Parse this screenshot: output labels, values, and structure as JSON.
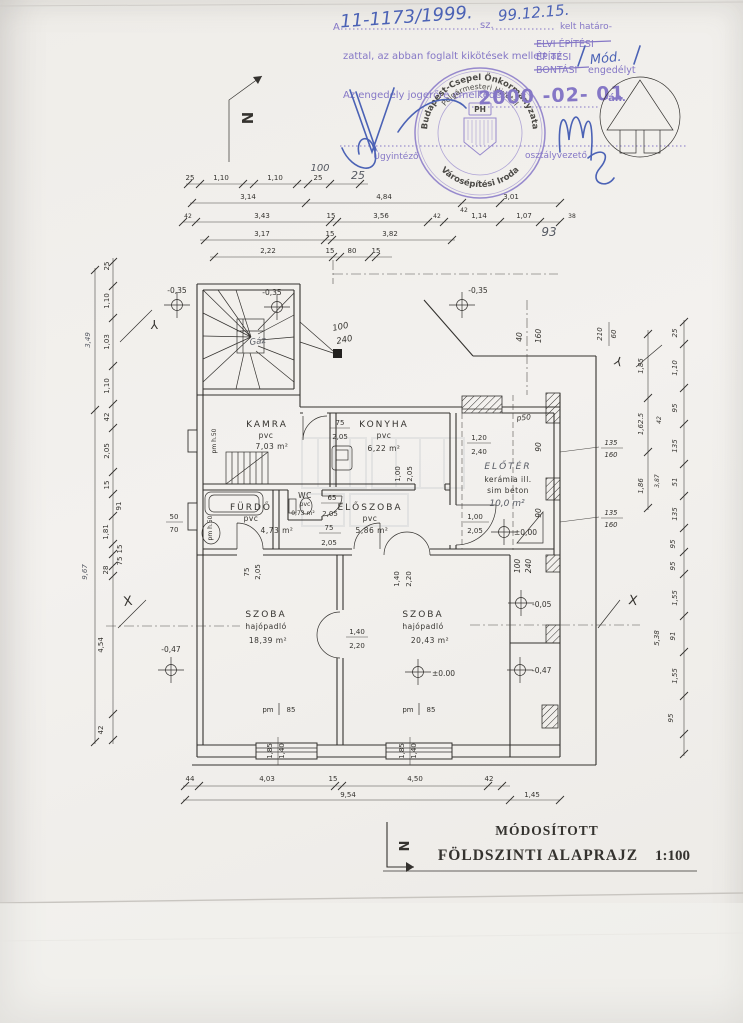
{
  "permit": {
    "a": "A",
    "case": "11-1173/1999.",
    "sz": "sz.",
    "date": "99.12.15.",
    "kelt": "kelt határo-",
    "l2": "zattal, az abban foglalt kikötések mellett az",
    "o1": "ELVI ÉPÍTÉSI",
    "o2": "ÉPÍTÉSI",
    "mod": "Mód.",
    "o3": "BONTÁSI",
    "eng": "engedélyt",
    "l3": "Az engedély jogerőre emelkedett",
    "stamp_date": "2000 -02- 01",
    "an": "-án.",
    "sig1": "Ügyintéző",
    "sig2": "osztályvezető"
  },
  "seal": {
    "r1": "Budapest-Csepel Önkormányzata",
    "r2": "Polgármesteri Hivatal",
    "ph": "PH",
    "r3": "Városépítési Iroda"
  },
  "title": {
    "t1": "MÓDOSÍTOTT",
    "t2": "FÖLDSZINTI ALAPRAJZ",
    "scale": "1:100"
  },
  "rooms": {
    "kamra": {
      "n": "KAMRA",
      "f": "pvc",
      "a": "7,03 m²"
    },
    "konyha": {
      "n": "KONYHA",
      "f": "pvc",
      "a": "6,22 m²"
    },
    "wc": {
      "n": "WC",
      "f": "pvc",
      "a": "0,73 m²"
    },
    "furdo": {
      "n": "FÜRDŐ",
      "f": "pvc",
      "a": "4,73 m²"
    },
    "eloszoba": {
      "n": "ELŐSZOBA",
      "f": "pvc",
      "a": "5,86 m²"
    },
    "eloter": {
      "n": "ELŐTÉR",
      "f1": "kerámia ill.",
      "f2": "sim beton",
      "a": "10,0 m²"
    },
    "szoba1": {
      "n": "SZOBA",
      "f": "hajópadló",
      "a": "18,39 m²"
    },
    "szoba2": {
      "n": "SZOBA",
      "f": "hajópadló",
      "a": "20,43 m²"
    },
    "gaz": "Gáz",
    "pm85": {
      "pm": "pm",
      "v": "85"
    },
    "pmh50": "pm h.50"
  },
  "levels": {
    "a": "-0,35",
    "b": "-0,35",
    "c": "-0,35",
    "d": "±0,00",
    "e": "±0.00",
    "f": "-0,05",
    "g": "-0,47",
    "h": "-0,47"
  },
  "doors": {
    "kamra": [
      "75",
      "2,05"
    ],
    "konyha_elo": [
      "1,00",
      "2,05"
    ],
    "wc": [
      "65",
      "2,05"
    ],
    "elo1": [
      "75",
      "2,05"
    ],
    "furdo_door": [
      "75",
      "2,05"
    ],
    "eloter_door": [
      "1,00",
      "2,05"
    ],
    "eloter_win": [
      "1,20",
      "2,40"
    ],
    "dbl": [
      "1,40",
      "2,20"
    ],
    "win2": [
      "1,40",
      "2,20"
    ],
    "furdo_win": [
      "50",
      "70"
    ],
    "win_a": [
      "1,85",
      "1,40"
    ],
    "win_b": [
      "1,85",
      "1,40"
    ],
    "wing_a": [
      "100",
      "240"
    ],
    "hw40": [
      "40",
      "160"
    ],
    "hw210": [
      "210",
      "60"
    ],
    "hw135a": [
      "135",
      "160"
    ],
    "hw135b": [
      "135",
      "160"
    ],
    "hw100240": [
      "100",
      "240"
    ]
  },
  "dims": {
    "t0": [
      "25",
      "1,10",
      "1,10",
      "25"
    ],
    "t0h": [
      "100",
      "25"
    ],
    "t1": [
      "3,14",
      "4,84",
      "42",
      "3,01"
    ],
    "t2": [
      "42",
      "3,43",
      "15",
      "3,56",
      "42",
      "1,14",
      "1,07",
      "38"
    ],
    "t2h": "93",
    "t3": [
      "3,17",
      "15",
      "3,82"
    ],
    "t4": [
      "2,22",
      "15",
      "80",
      "15"
    ],
    "b1": [
      "44",
      "4,03",
      "15",
      "4,50",
      "42"
    ],
    "b2": [
      "9,54",
      "1,45"
    ],
    "L": [
      "25",
      "1,10",
      "1,03",
      "1,10",
      "42",
      "2,05",
      "15",
      "91",
      "1,81",
      "15",
      "75",
      "28",
      "4,54",
      "42"
    ],
    "Lt": [
      "3,49",
      "9,67"
    ],
    "R": [
      "25",
      "1,10",
      "95",
      "135",
      "51",
      "135",
      "95",
      "95",
      "1,55",
      "91",
      "1,55",
      "95"
    ],
    "Ri": [
      "1,85",
      "1,62.5",
      "1,86"
    ],
    "Rs": [
      "42",
      "3,87",
      "5,38"
    ],
    "hw": {
      "a": "90",
      "b": "90",
      "p50": "p50"
    }
  },
  "misc": {
    "n1": "N",
    "n2": "N",
    "x1": "X",
    "x2": "X",
    "y1": "Y",
    "y2": "Y"
  }
}
